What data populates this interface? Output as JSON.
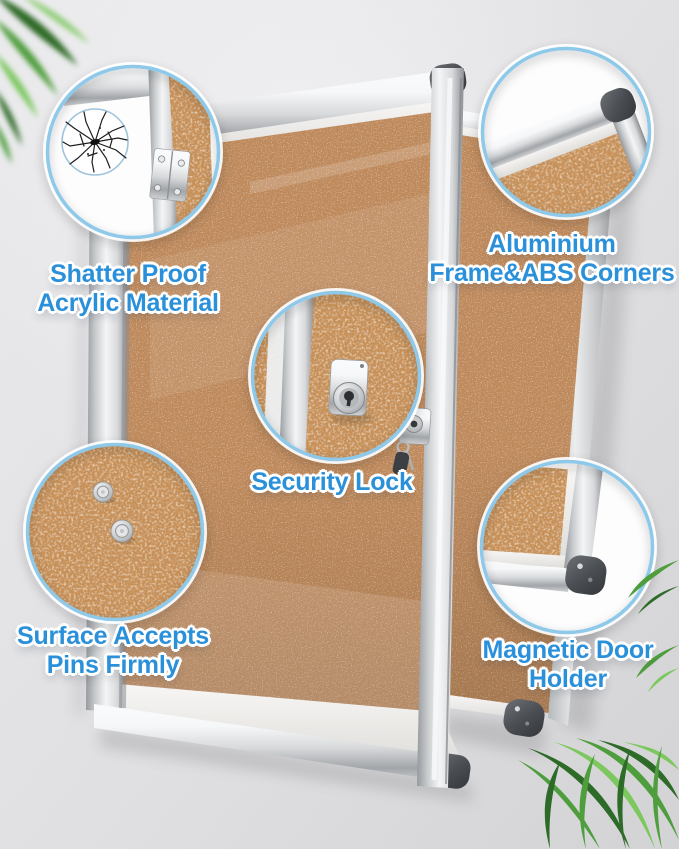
{
  "image_type": "product-feature-photo",
  "product": "cork bulletin board with lockable aluminium-framed acrylic door",
  "callouts": {
    "shatterproof": {
      "line1": "Shatter Proof",
      "line2": "Acrylic Material",
      "icon": "shattered-glass-icon"
    },
    "aluminium_frame": {
      "line1": "Aluminium",
      "line2": "Frame&ABS Corners",
      "icon": "frame-corner-icon"
    },
    "security_lock": {
      "line1": "Security Lock",
      "icon": "cam-lock-icon"
    },
    "pin_surface": {
      "line1": "Surface Accepts",
      "line2": "Pins Firmly",
      "icon": "push-pins-icon"
    },
    "magnetic_holder": {
      "line1": "Magnetic Door",
      "line2": "Holder",
      "icon": "door-corner-magnet-icon"
    }
  },
  "colors": {
    "label-text": "#2b90da",
    "callout-border": "#8ec9ea",
    "cork": "#c0885a",
    "cork-zoom": "#cb9157",
    "silver-light": "#f6f7f8",
    "silver-mid": "#d7d9db",
    "silver-dark": "#a2a5a9",
    "abs-corner": "#4b4f54",
    "wall-light": "#ebebed",
    "wall-dark": "#d3d3d5",
    "leaf-dark": "#2e6b28",
    "leaf-mid": "#4f9e3e",
    "leaf-light": "#7cc85f"
  }
}
